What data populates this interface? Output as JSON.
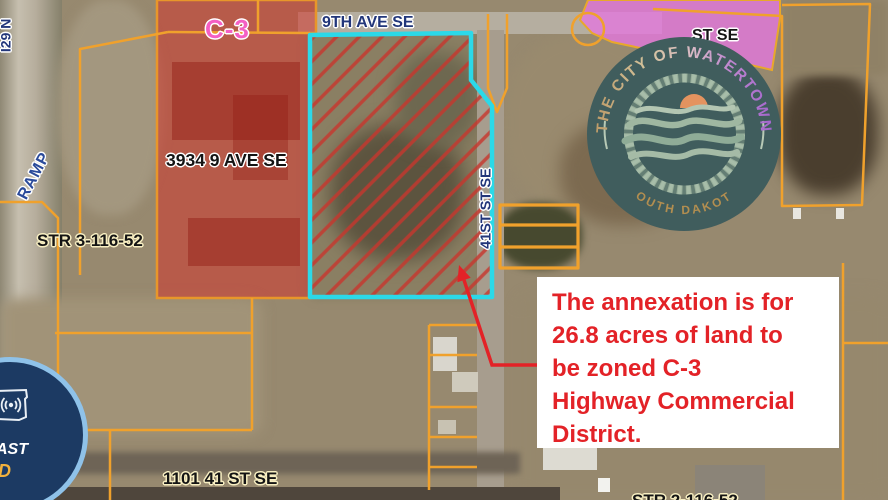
{
  "map_labels": {
    "interstate": "I29 N",
    "ramp": "RAMP",
    "zone_c3": "C-3",
    "street_9th_ave": "9TH AVE SE",
    "address_3934": "3934 9 AVE SE",
    "section_str3": "STR 3-116-52",
    "street_41st": "41ST ST SE",
    "street_partial": "ST SE",
    "address_1101": "1101 41 ST SE",
    "section_str2": "STR 2-116-52"
  },
  "annotation": {
    "lines": [
      "The annexation is for",
      "26.8 acres of land to",
      "be zoned C-3",
      "Highway Commercial",
      "District."
    ]
  },
  "logo": {
    "arc_top": "THE CITY OF WATERTOWN",
    "arc_bottom": "SOUTH DAKOTA"
  },
  "badge": {
    "line1": "AST",
    "line2": "D"
  },
  "colors": {
    "annex_outline": "#2bd9e8",
    "parcel_line": "#f0a12c",
    "zone_red": "#d2342b",
    "zone_pink": "#e378dd",
    "hatch_red": "#c8352c",
    "annotation_red": "#e32227",
    "label_blue": "#22367a",
    "label_pink": "#f45fc4"
  }
}
